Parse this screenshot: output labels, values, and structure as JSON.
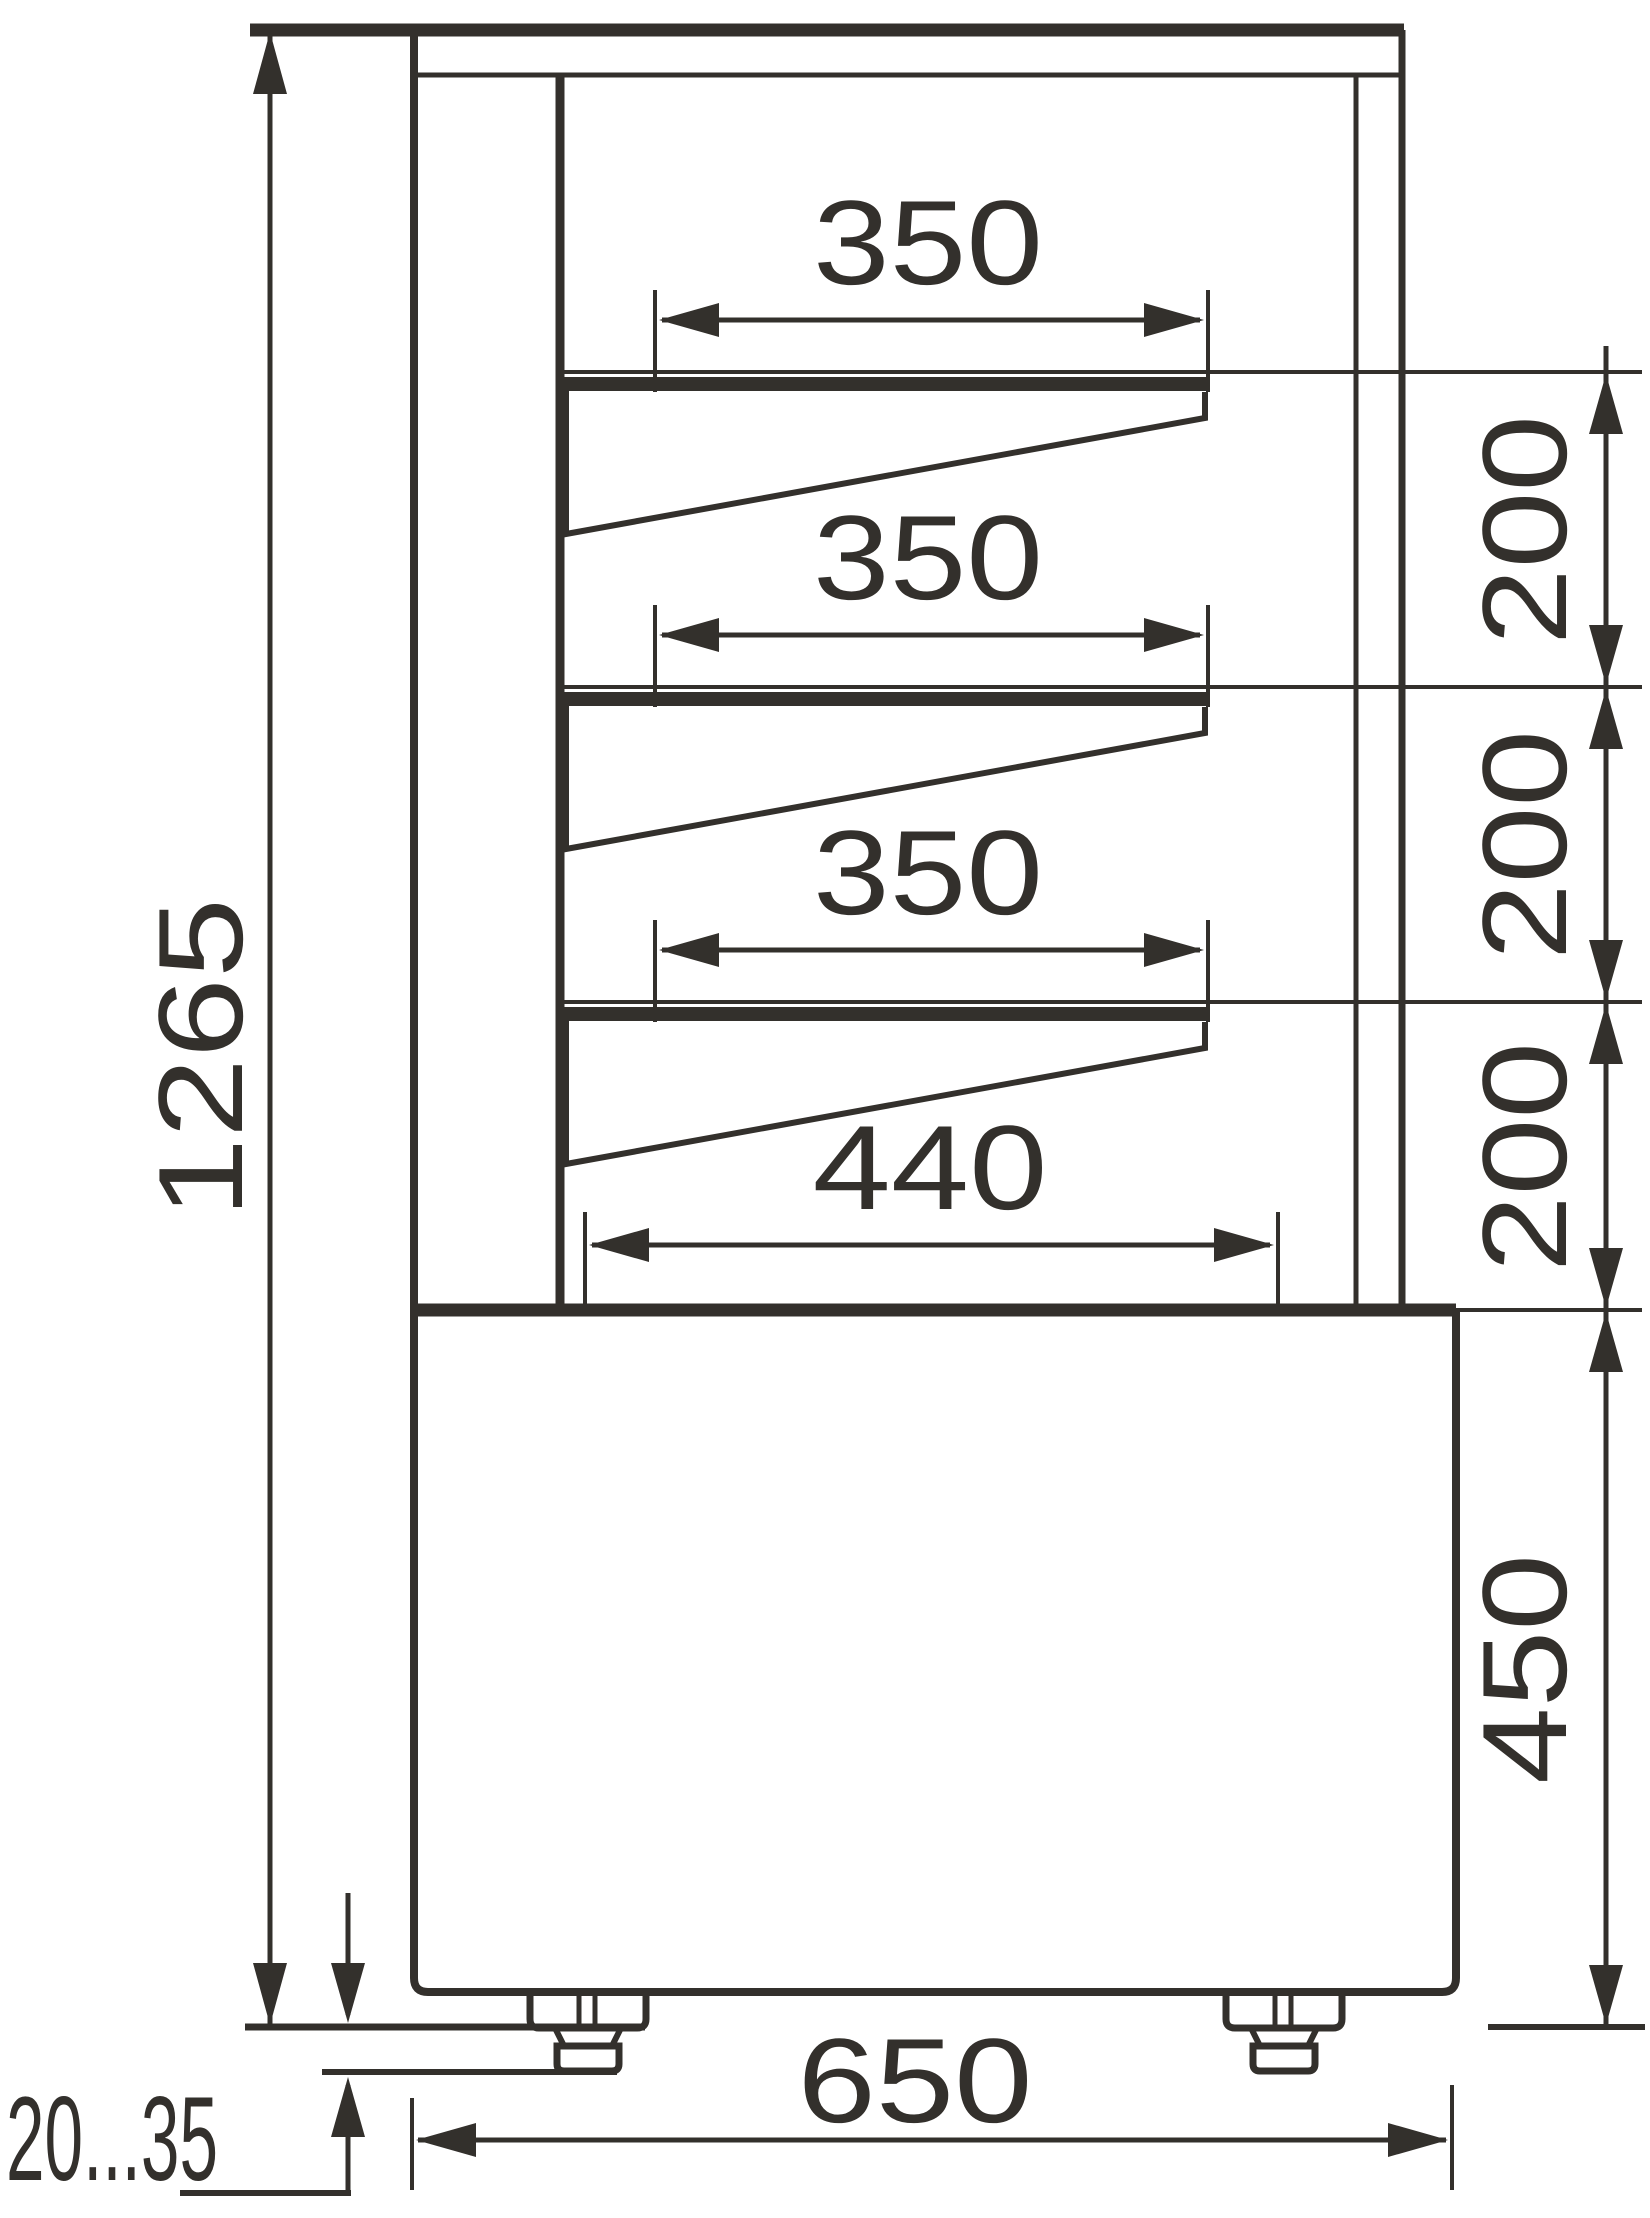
{
  "diagram": {
    "type": "technical-dimension-drawing",
    "view": "side-section-profile",
    "units": "mm",
    "subject": "display case side view with three bracket shelves, bottom deck, base cabinet and adjustable feet"
  },
  "dimensions": {
    "overall_height": "1265",
    "shelf1_width": "350",
    "shelf2_width": "350",
    "shelf3_width": "350",
    "bottom_deck_width": "440",
    "spacing1": "200",
    "spacing2": "200",
    "spacing3": "200",
    "base_height": "450",
    "base_depth": "650",
    "foot_adjust_range": "20...35"
  }
}
